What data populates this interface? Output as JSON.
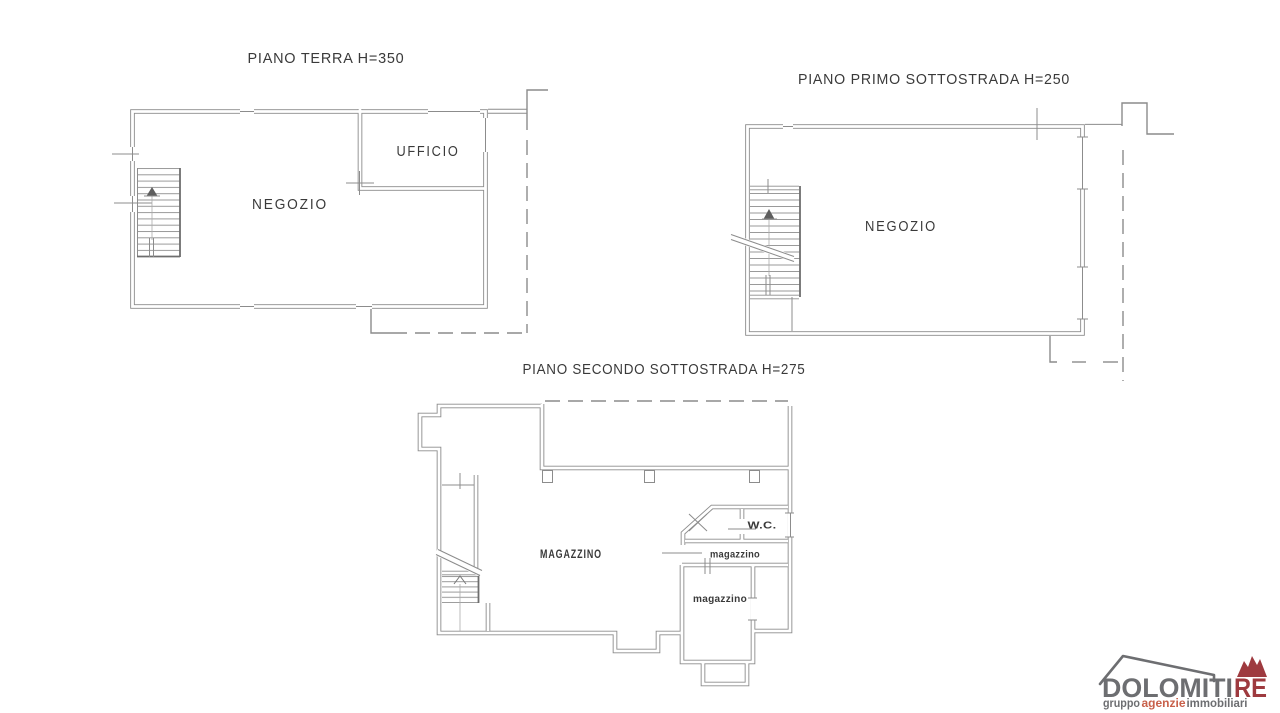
{
  "plans": {
    "terra": {
      "title": "PIANO TERRA H=350",
      "negozio": "NEGOZIO",
      "ufficio": "UFFICIO"
    },
    "primo": {
      "title": "PIANO PRIMO SOTTOSTRADA H=250",
      "negozio": "NEGOZIO"
    },
    "secondo": {
      "title": "PIANO SECONDO SOTTOSTRADA H=275",
      "magazzino_main": "MAGAZZINO",
      "wc": "W.C.",
      "magazzino_mid": "magazzino",
      "magazzino_low": "magazzino"
    }
  },
  "logo": {
    "brand_gray": "DOLOMITI",
    "brand_red": "RE",
    "tagline_gray1": "gruppo",
    "tagline_red": "agenzie",
    "tagline_gray2": "immobiliari"
  },
  "colors": {
    "wall_line": "#8c8c8c",
    "dark_line": "#6e6e6e",
    "label_text": "#3a3a3a",
    "logo_gray": "#6d6e71",
    "logo_red": "#9e3a3f",
    "logo_orange": "#c8604a"
  }
}
